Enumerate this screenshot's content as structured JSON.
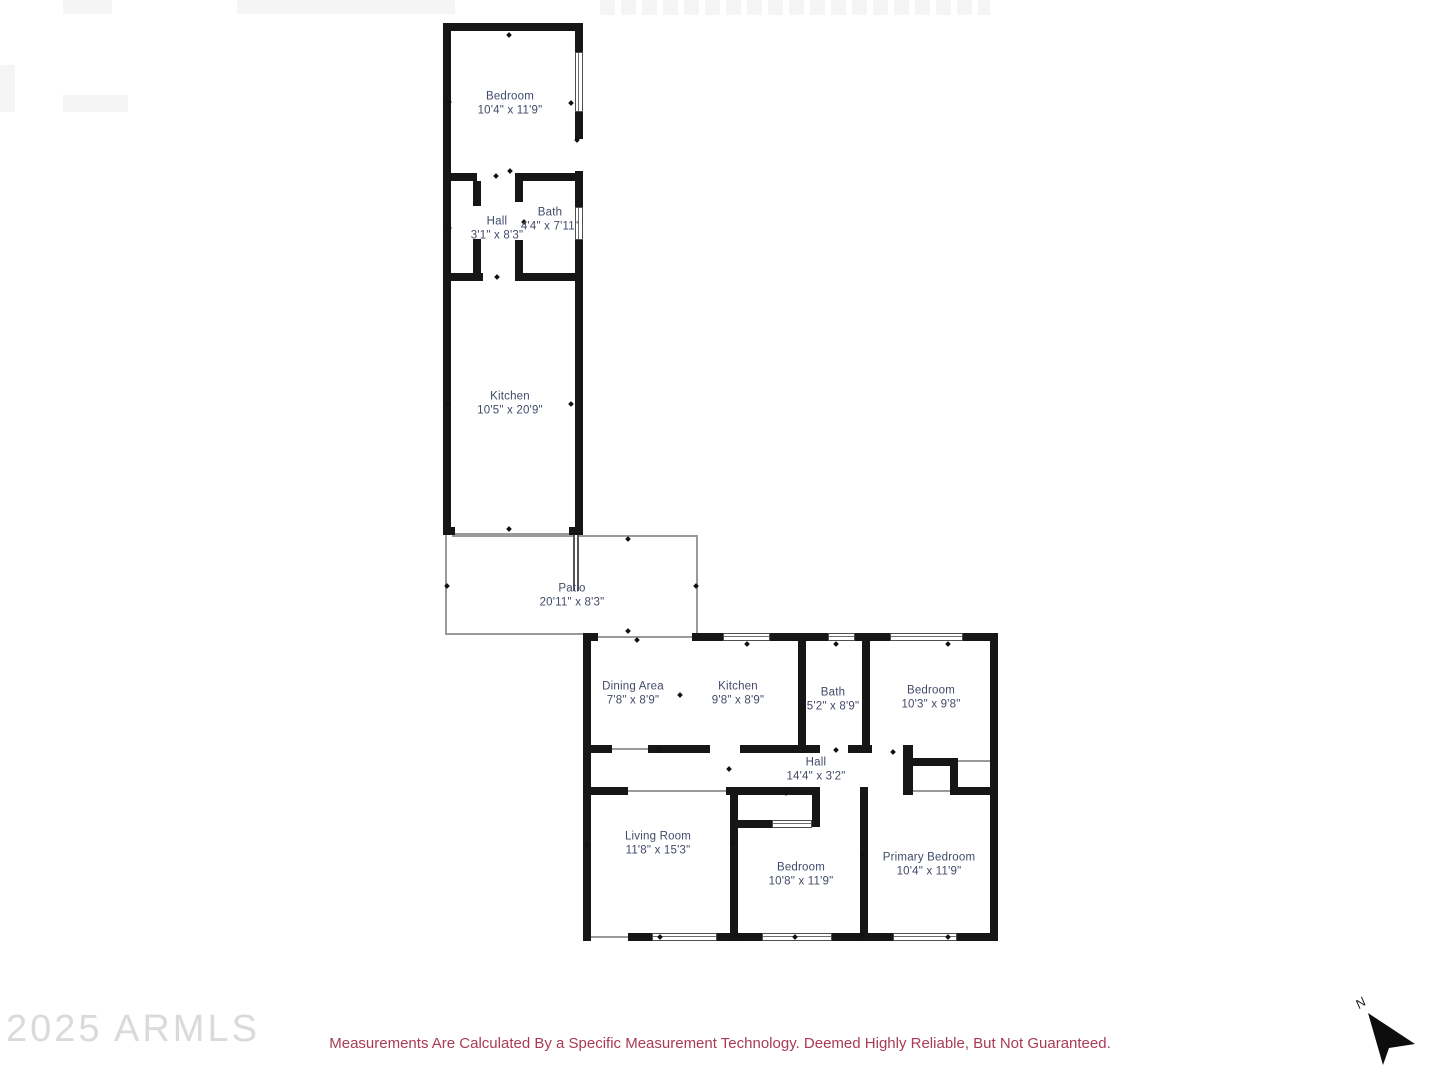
{
  "watermark": {
    "text": "2025 ARMLS"
  },
  "disclaimer": {
    "text": "Measurements Are Calculated By a Specific Measurement Technology. Deemed Highly Reliable, But Not Guaranteed."
  },
  "north": {
    "label": "N"
  },
  "colors": {
    "wall": "#161616",
    "room_label": "#424a69",
    "disclaimer_text": "#a93a54",
    "watermark_text": "#dadada",
    "thin_line": "#9a9a9a"
  },
  "rooms": [
    {
      "name": "Bedroom",
      "dims": "10'4\" x 11'9\""
    },
    {
      "name": "Hall",
      "dims": "3'1\" x 8'3\""
    },
    {
      "name": "Bath",
      "dims": "4'4\" x 7'11\""
    },
    {
      "name": "Kitchen",
      "dims": "10'5\" x 20'9\""
    },
    {
      "name": "Patio",
      "dims": "20'11\" x 8'3\""
    },
    {
      "name": "Dining Area",
      "dims": "7'8\" x 8'9\""
    },
    {
      "name": "Kitchen",
      "dims": "9'8\" x 8'9\""
    },
    {
      "name": "Bath",
      "dims": "5'2\" x 8'9\""
    },
    {
      "name": "Bedroom",
      "dims": "10'3\" x 9'8\""
    },
    {
      "name": "Hall",
      "dims": "14'4\" x 3'2\""
    },
    {
      "name": "Living Room",
      "dims": "11'8\" x 15'3\""
    },
    {
      "name": "Bedroom",
      "dims": "10'8\" x 11'9\""
    },
    {
      "name": "Primary Bedroom",
      "dims": "10'4\" x 11'9\""
    }
  ]
}
